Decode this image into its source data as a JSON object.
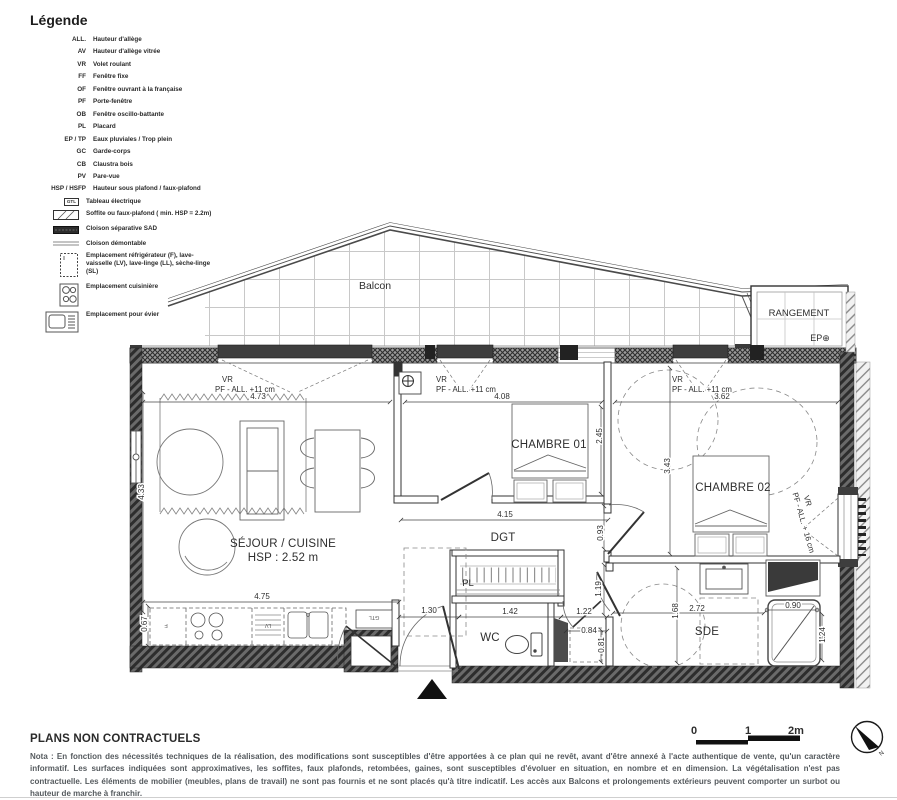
{
  "legend": {
    "title": "Légende",
    "entries": [
      {
        "abbr": "ALL.",
        "label": "Hauteur d'allège"
      },
      {
        "abbr": "AV",
        "label": "Hauteur d'allège vitrée"
      },
      {
        "abbr": "VR",
        "label": "Volet roulant"
      },
      {
        "abbr": "FF",
        "label": "Fenêtre fixe"
      },
      {
        "abbr": "OF",
        "label": "Fenêtre ouvrant à la française"
      },
      {
        "abbr": "PF",
        "label": "Porte-fenêtre"
      },
      {
        "abbr": "OB",
        "label": "Fenêtre oscillo-battante"
      },
      {
        "abbr": "PL",
        "label": "Placard"
      },
      {
        "abbr": "EP / TP",
        "label": "Eaux pluviales / Trop plein"
      },
      {
        "abbr": "GC",
        "label": "Garde-corps"
      },
      {
        "abbr": "CB",
        "label": "Claustra bois"
      },
      {
        "abbr": "PV",
        "label": "Pare-vue"
      },
      {
        "abbr": "HSP / HSFP",
        "label": "Hauteur sous plafond / faux-plafond"
      }
    ],
    "icon_entries": [
      {
        "icon": "gtl-box",
        "icon_text": "GTL",
        "label": "Tableau électrique"
      },
      {
        "icon": "soffit-hatch",
        "label": "Soffite ou faux-plafond ( min. HSP = 2.2m)"
      },
      {
        "icon": "separating-partition",
        "label": "Cloison séparative SAD"
      },
      {
        "icon": "demountable-partition",
        "label": "Cloison démontable"
      },
      {
        "icon": "appliance-box",
        "label": "Emplacement réfrigérateur (F), lave-vaisselle (LV), lave-linge (LL), sèche-linge (SL)"
      },
      {
        "icon": "cooktop",
        "label": "Emplacement cuisinière"
      },
      {
        "icon": "sink",
        "label": "Emplacement pour évier"
      }
    ]
  },
  "plan": {
    "balcony": "Balcon",
    "storage": "RANGEMENT",
    "storage_ep": "EP⊕",
    "bedroom1": "CHAMBRE 01",
    "bedroom2": "CHAMBRE 02",
    "living": "SÉJOUR / CUISINE",
    "living_hsp": "HSP : 2.52 m",
    "hall": "DGT",
    "wc": "WC",
    "shower_room": "SDE",
    "closet": "PL",
    "gtl": "GTL",
    "fridge": "F",
    "dishwasher": "LV",
    "notes": {
      "vr": "VR",
      "pf11": "PF - ALL. +11 cm",
      "pf16": "PF - ALL. + 16 cm"
    },
    "dims": {
      "living_w": "4.73",
      "bed1_w": "4.08",
      "bed2_w": "3.62",
      "bed1_w_bottom": "4.15",
      "kitchen_w": "4.75",
      "living_d": "4.33",
      "bed1_d": "2.45",
      "bed2_d": "3.43",
      "pass1": "0.93",
      "pass2": "1.19",
      "pass3": "0.81",
      "entry_w": "1.30",
      "closet_w": "1.42",
      "lobby_w": "1.22",
      "niche_w": "0.84",
      "sde_w": "2.72",
      "sde_d": "1.68",
      "shower_w": "0.90",
      "shower_d": "1.24",
      "kitchen_d": "0.67"
    }
  },
  "scalebar": {
    "zero": "0",
    "one": "1",
    "two": "2m"
  },
  "compass": {
    "north": "N"
  },
  "footer": {
    "title": "PLANS NON CONTRACTUELS",
    "nota": "Nota : En fonction des nécessités techniques de la réalisation, des modifications sont susceptibles d'être apportées à ce plan qui ne revêt, avant d'être annexé à l'acte authentique de vente, qu'un caractère informatif. Les surfaces indiquées sont approximatives, les soffites, faux plafonds, retombées, gaines, sont susceptibles d'évoluer en situation, en nombre et en dimension. La végétalisation n'est pas contractuelle. Les éléments de mobilier (meubles, plans de travail) ne sont pas fournis et ne sont placés qu'à titre indicatif. Les accès aux Balcons et prolongements extérieurs peuvent comporter un surbot ou hauteur de marche à franchir."
  }
}
